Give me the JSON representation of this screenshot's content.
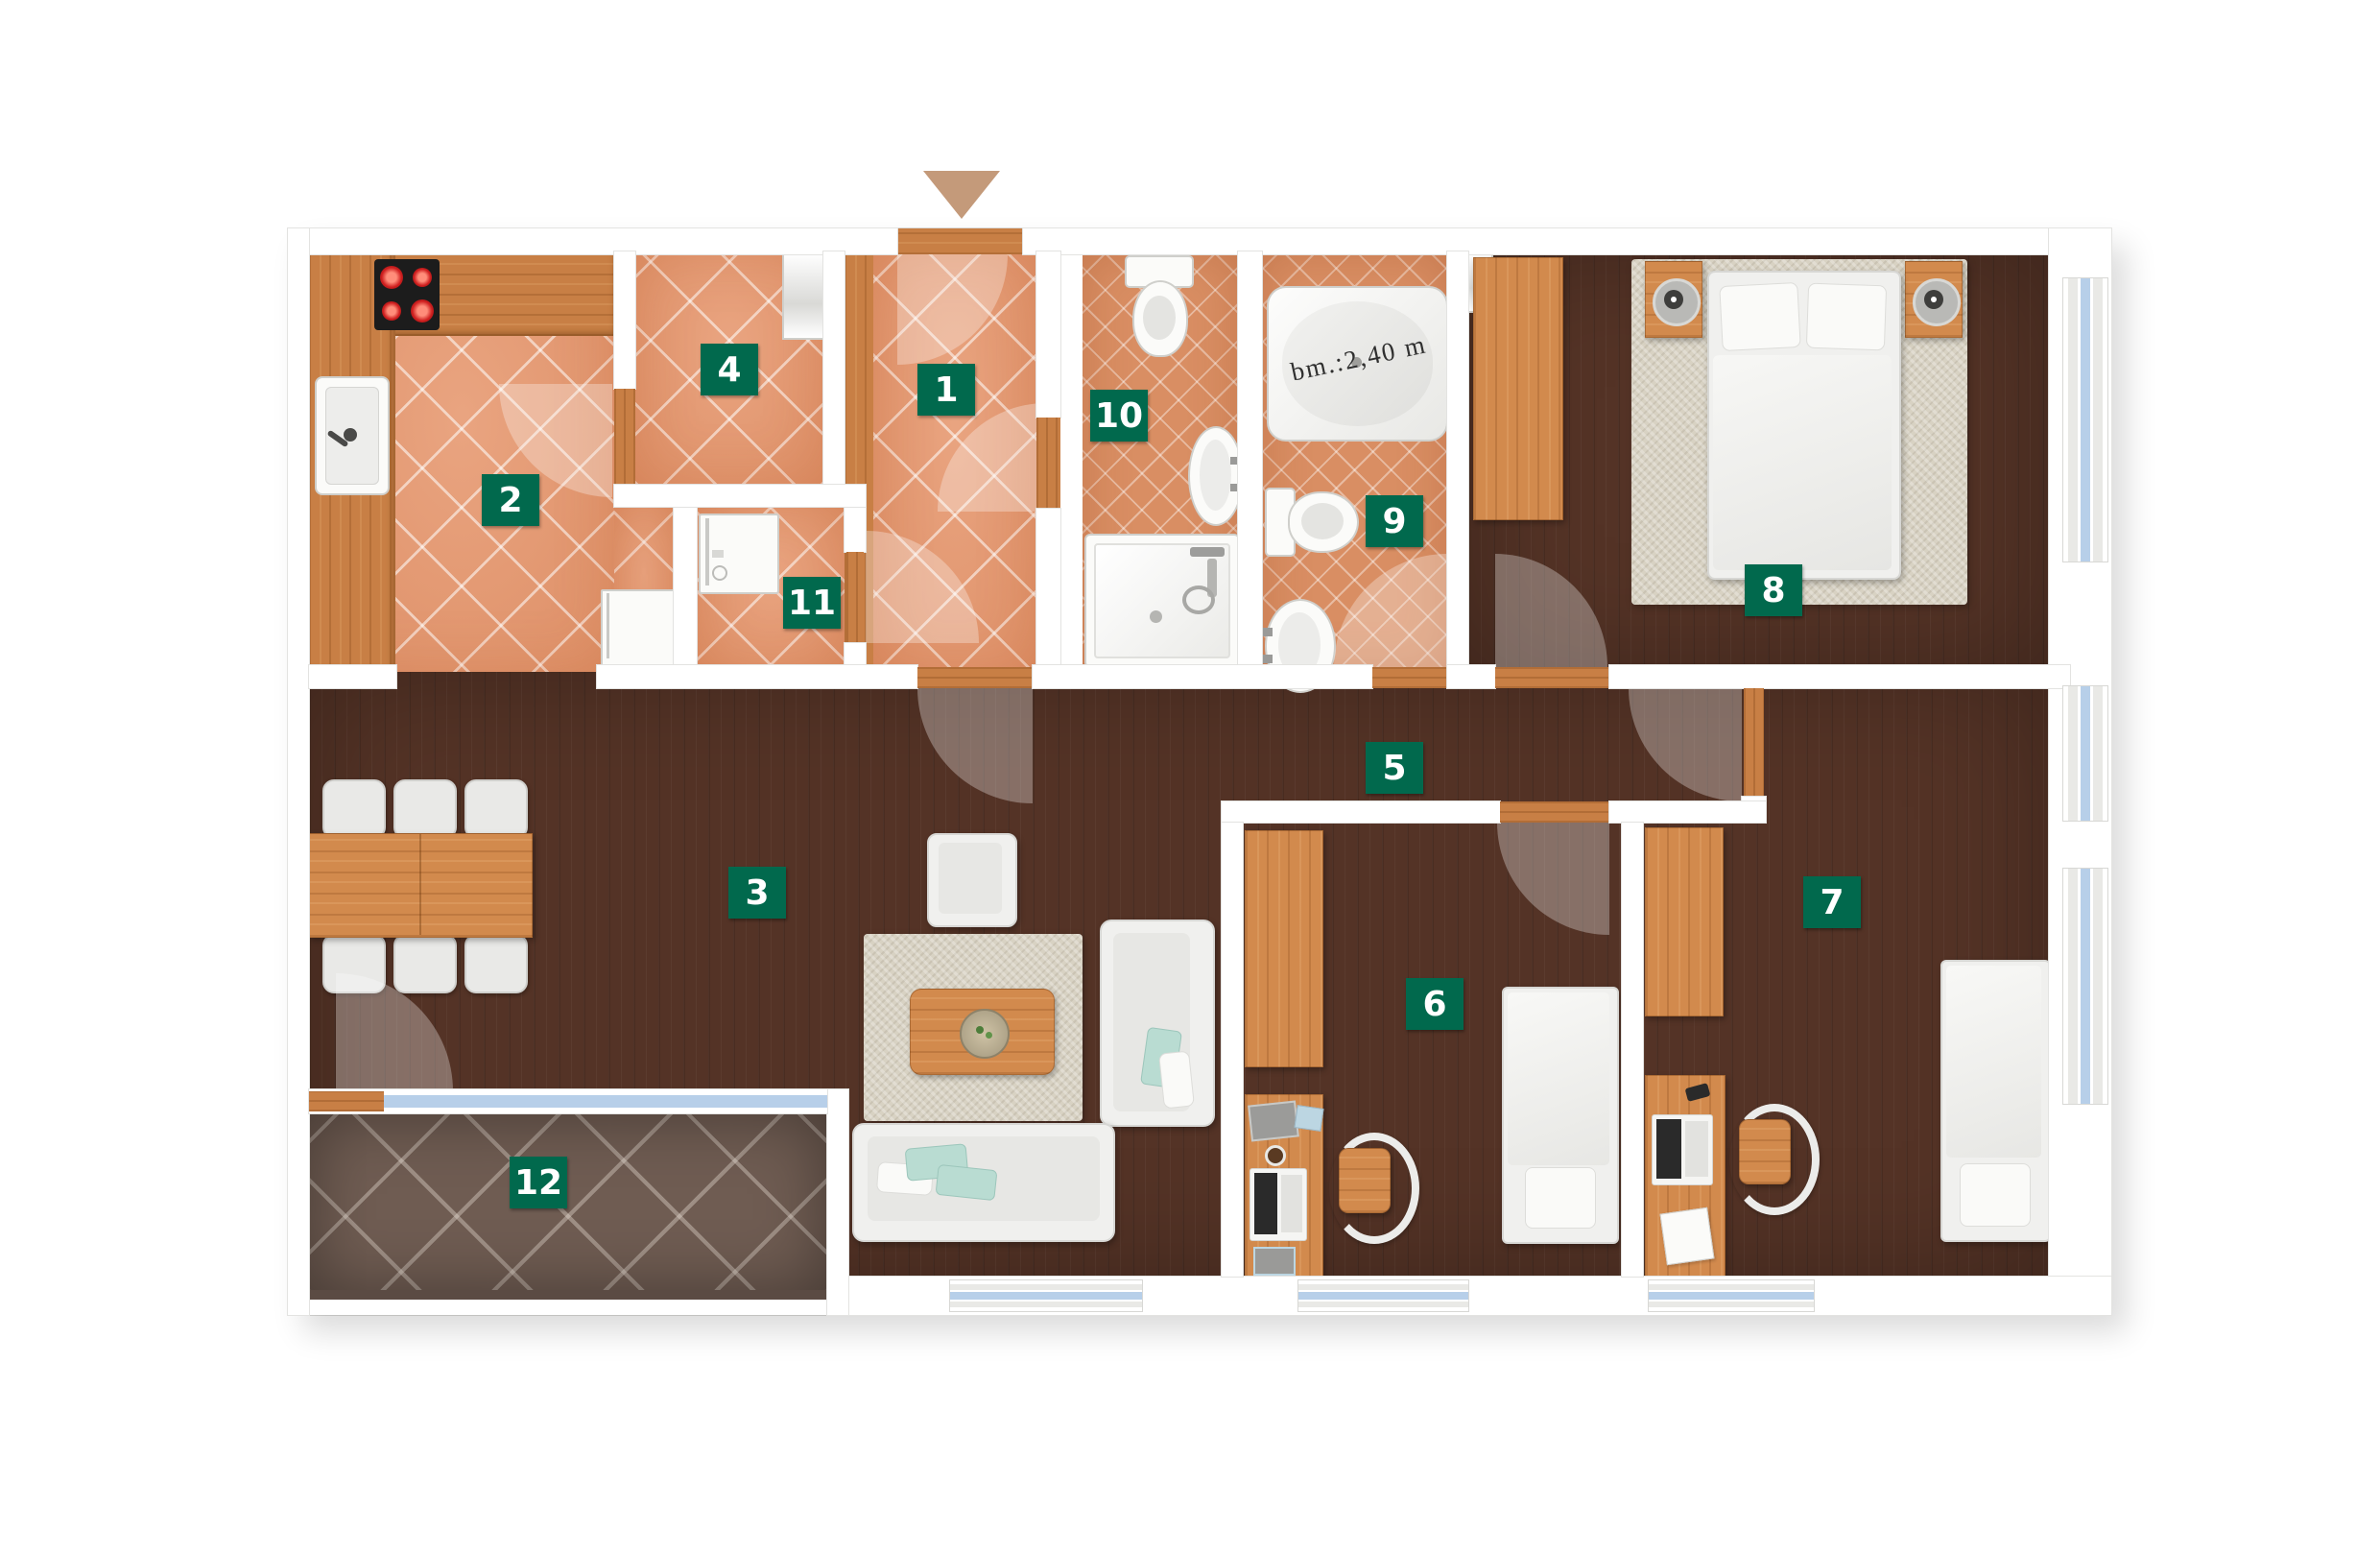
{
  "rooms": [
    {
      "number": "1"
    },
    {
      "number": "2"
    },
    {
      "number": "3"
    },
    {
      "number": "4"
    },
    {
      "number": "5"
    },
    {
      "number": "6"
    },
    {
      "number": "7"
    },
    {
      "number": "8"
    },
    {
      "number": "9"
    },
    {
      "number": "10"
    },
    {
      "number": "11"
    },
    {
      "number": "12"
    }
  ],
  "bathtub": {
    "dimension_text": "bm.:2,40 m"
  },
  "colors": {
    "labelbg": "#01694d",
    "labeltext": "#ffffff",
    "tile": "#e79a72",
    "bathtile": "#d98e63",
    "wood": "#c87f45",
    "darkfloor": "#543326",
    "balcony": "#6f5c52",
    "glass": "#b7cfe9",
    "arrow": "#c49a7a",
    "wall": "#ffffff"
  }
}
